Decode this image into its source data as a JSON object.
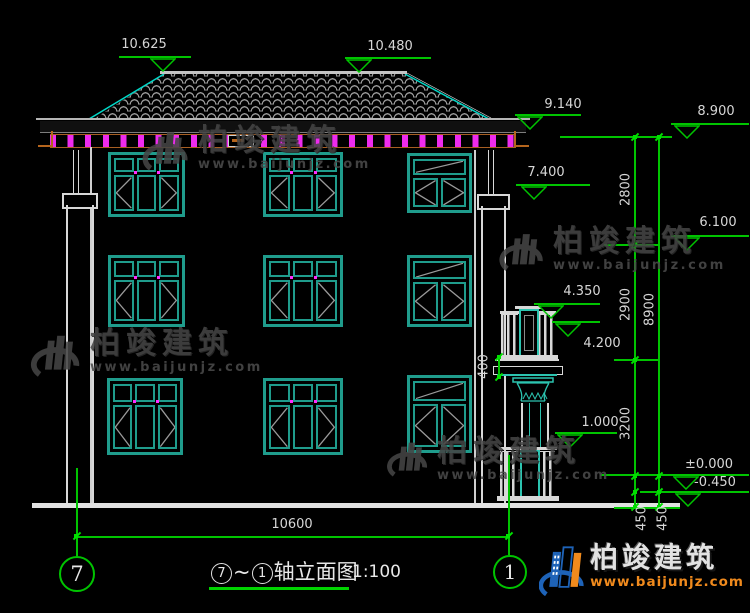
{
  "levels": {
    "top_left": "10.625",
    "top_right": "10.480",
    "eave": "9.140",
    "wall_top": "8.900",
    "floor3": "7.400",
    "floor2": "6.100",
    "balcony_rail": "4.350",
    "balcony_floor": "4.200",
    "porch_rail": "1.000",
    "zero": "±0.000",
    "ground": "-0.450"
  },
  "dims": {
    "seg_top": "2800",
    "seg_mid": "2900",
    "seg_bottom": "3200",
    "total_height": "8900",
    "plinth_a": "450",
    "plinth_b": "450",
    "balcony_slab": "400",
    "total_width": "10600"
  },
  "axes": {
    "left": "7",
    "right": "1"
  },
  "title_block": {
    "axis_from": "7",
    "separator": "~",
    "axis_to": "1",
    "name": "轴立面图",
    "scale": "1:100"
  },
  "watermark": {
    "name": "柏竣建筑",
    "url": "www.baijunjz.com"
  },
  "brand": {
    "name": "柏竣建筑",
    "url": "www.baijunjz.com"
  },
  "colors": {
    "dimension_green": "#00c400",
    "window_teal": "#1f9c8c",
    "hip_cyan": "#00d8c8",
    "rafter_magenta": "#ee2bee",
    "brand_orange": "#f08a1d",
    "brand_blue": "#1e63b8"
  }
}
